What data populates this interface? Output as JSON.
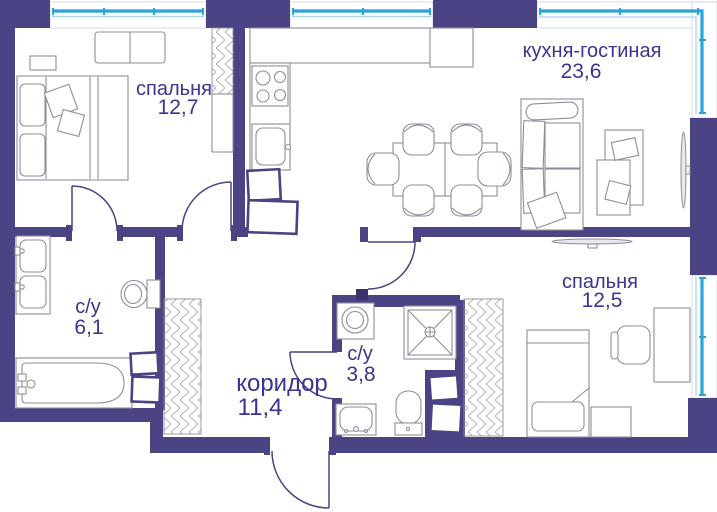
{
  "plan_title": "apartment floor plan",
  "rooms": {
    "bedroom1": {
      "name": "спальня",
      "area": "12,7"
    },
    "kitchen_living": {
      "name": "кухня-гостиная",
      "area": "23,6"
    },
    "bathroom1": {
      "name": "с/у",
      "area": "6,1"
    },
    "corridor": {
      "name": "коридор",
      "area": "11,4"
    },
    "bathroom2": {
      "name": "с/у",
      "area": "3,8"
    },
    "bedroom2": {
      "name": "спальня",
      "area": "12,5"
    }
  },
  "colors": {
    "wall": "#4a4384",
    "window_frame": "#2ba3d4",
    "window_frame_light": "#a8d4ea",
    "label_text": "#3b3490",
    "furniture_line": "#8e8e9a"
  }
}
